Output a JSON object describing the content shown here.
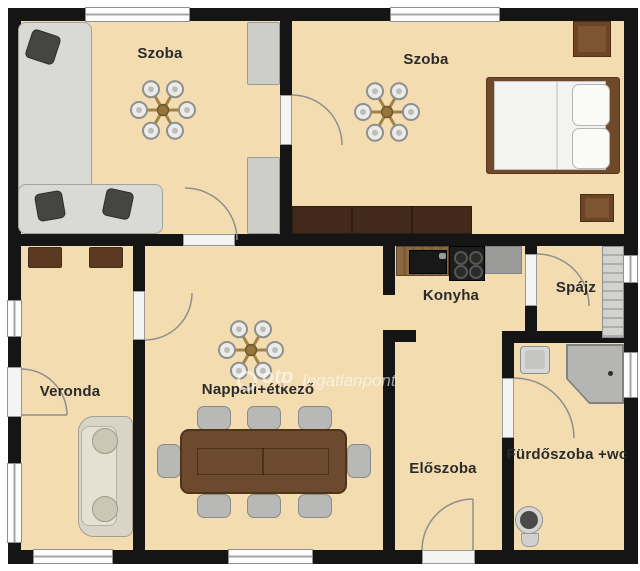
{
  "plan": {
    "title": "Apartment floor plan",
    "rooms": [
      {
        "id": "szoba-1",
        "label": "Szoba"
      },
      {
        "id": "szoba-2",
        "label": "Szoba"
      },
      {
        "id": "konyha",
        "label": "Konyha"
      },
      {
        "id": "spajz",
        "label": "Spájz"
      },
      {
        "id": "veronda",
        "label": "Veronda"
      },
      {
        "id": "nappali",
        "label": "Nappali+étkező"
      },
      {
        "id": "eloszoba",
        "label": "Előszoba"
      },
      {
        "id": "furdoszoba",
        "label": "Fürdőszoba +wc"
      }
    ],
    "watermark": {
      "brand": "otp",
      "name": "Ingatlanpont"
    },
    "colors": {
      "floor": "#f3dcb0",
      "wall": "#151515",
      "label_text": "#2b2b2b",
      "window": "#fdfdfd",
      "wood_dark": "#42291a",
      "wood_mid": "#6b4a2e",
      "furniture_gray": "#d9d9d5",
      "counter_gray": "#9b9b99"
    }
  }
}
